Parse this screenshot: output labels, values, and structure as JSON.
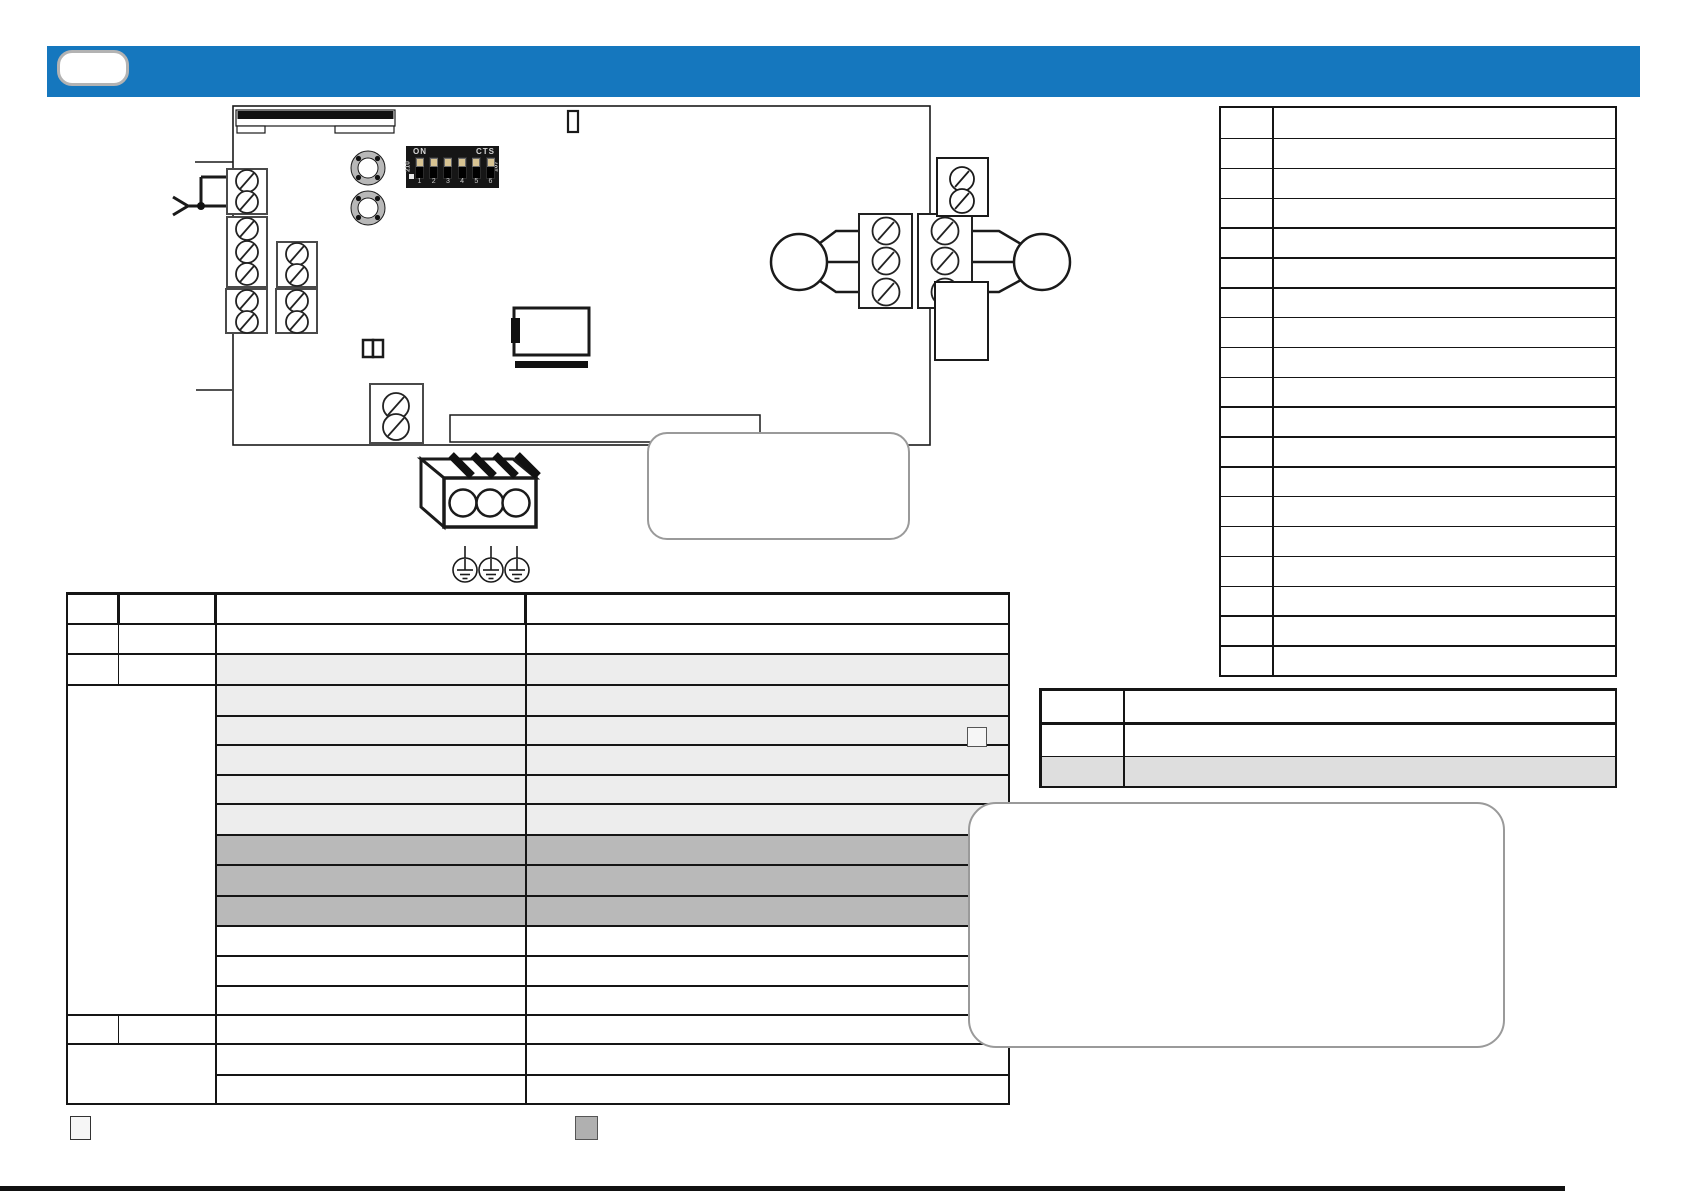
{
  "page": {
    "width": 1685,
    "height": 1192
  },
  "header_bar": {
    "badge_label": "",
    "color": "#1577BE"
  },
  "diagram": {
    "dip_switch": {
      "on_label": "ON",
      "cts_label": "CTS",
      "side_left_code": "210",
      "side_right_code": "107",
      "positions": [
        "1",
        "2",
        "3",
        "4",
        "5",
        "6"
      ]
    },
    "icons": [
      "screw-terminal-icon",
      "grommet-icon",
      "earth-ground-icon",
      "mains-connector-icon",
      "relay-icon"
    ]
  },
  "tables": {
    "main_wiring_table": {
      "columns": 4,
      "light_row_color": "#EDEDED",
      "dark_row_color": "#B9B9B9",
      "light_rows": 6,
      "dark_rows": 3
    },
    "component_table": {
      "columns": 2,
      "rows": 19
    },
    "bottom_right_table": {
      "columns": 2,
      "rows": 3,
      "gray_row_color": "#DEDEDE"
    }
  },
  "legend": {
    "light_color": "#F6F6F6",
    "dark_color": "#B0B0B0",
    "small_square_color": "#D2D2D2"
  },
  "footer": {
    "bar_color": "#111111"
  }
}
